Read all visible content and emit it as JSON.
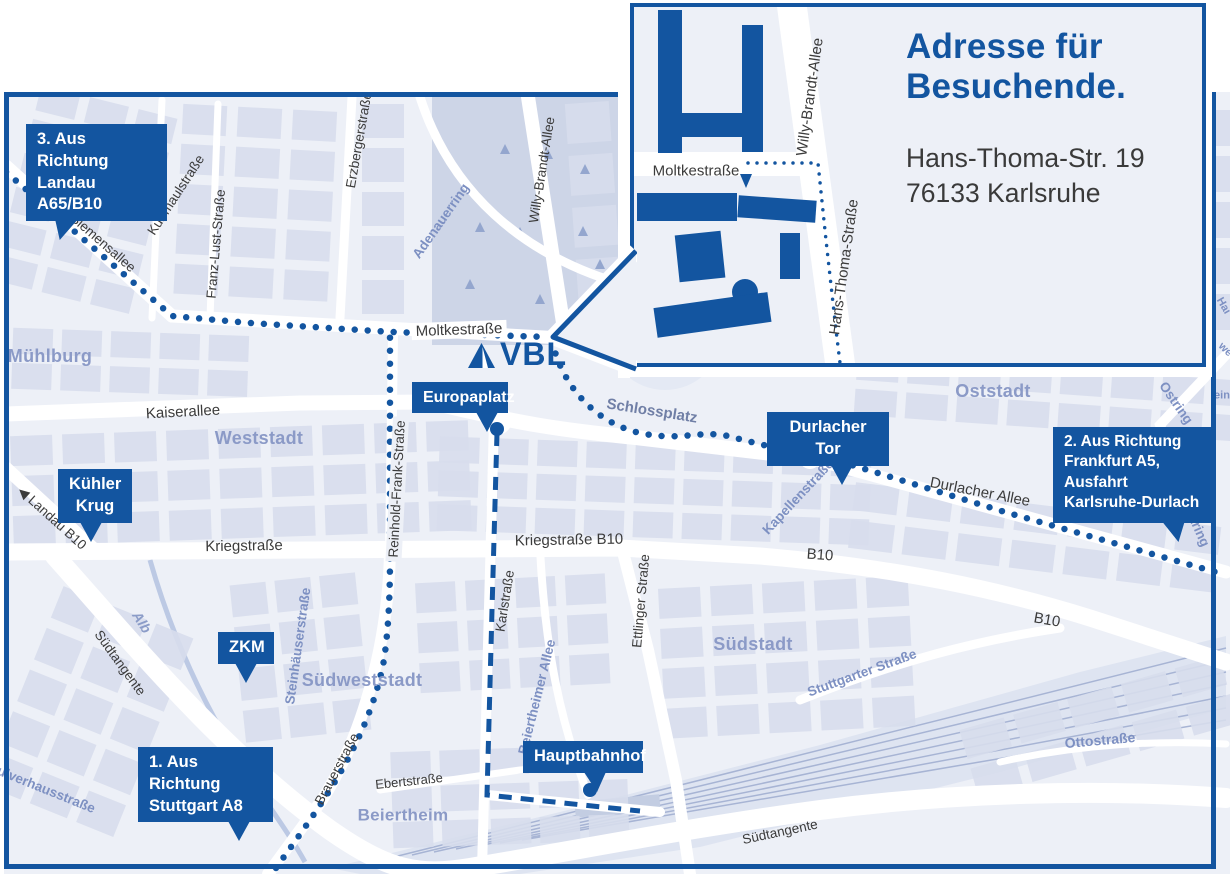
{
  "colors": {
    "brand": "#1355a0",
    "map_bg": "#edf0f7",
    "block": "#d7ddec",
    "park": "#cdd5e7",
    "district_text": "#8b9ac7",
    "street_text": "#3b3b3b",
    "street_text_blue": "#7d90c2",
    "route": "#1355a0"
  },
  "logo": {
    "text": "VBL"
  },
  "inset": {
    "title": "Adresse für\nBesuchende.",
    "address": "Hans-Thoma-Str. 19\n76133 Karlsruhe",
    "labels": [
      {
        "text": "Moltkestraße",
        "x": 62,
        "y": 164,
        "rot": 0
      },
      {
        "text": "Willy-Brandt-Allee",
        "x": 176,
        "y": 90,
        "rot": -82
      },
      {
        "text": "Hans-Thoma-Straße",
        "x": 210,
        "y": 260,
        "rot": -82
      }
    ]
  },
  "callouts": [
    {
      "id": "landau",
      "label": "3. Aus Richtung\nLandau A65/B10",
      "x": 26,
      "y": 124,
      "w": 141,
      "h": 48,
      "align": "left",
      "tail_x": 26,
      "tail_skew": -18,
      "fs": 16.5
    },
    {
      "id": "kuehler-krug",
      "label": "Kühler\nKrug",
      "x": 58,
      "y": 469,
      "w": 74,
      "h": 46,
      "align": "center",
      "tail_x": 22,
      "tail_skew": 0,
      "fs": 16.5
    },
    {
      "id": "zkm",
      "label": "ZKM",
      "x": 218,
      "y": 632,
      "w": 56,
      "h": 28,
      "align": "center",
      "tail_x": 17,
      "tail_skew": 0,
      "fs": 16.5
    },
    {
      "id": "stuttgart",
      "label": "1. Aus Richtung\nStuttgart A8",
      "x": 138,
      "y": 747,
      "w": 135,
      "h": 50,
      "align": "left",
      "tail_x": 90,
      "tail_skew": 0,
      "fs": 16.5
    },
    {
      "id": "europaplatz",
      "label": "Europaplatz",
      "x": 412,
      "y": 382,
      "w": 96,
      "h": 28,
      "align": "center",
      "tail_x": 64,
      "tail_skew": 0,
      "fs": 16
    },
    {
      "id": "durlacher-tor",
      "label": "Durlacher Tor",
      "x": 767,
      "y": 412,
      "w": 122,
      "h": 27,
      "align": "center",
      "tail_x": 64,
      "tail_skew": 0,
      "fs": 16.5
    },
    {
      "id": "frankfurt",
      "label": "2. Aus Richtung\nFrankfurt A5,\nAusfahrt\nKarlsruhe-Durlach",
      "x": 1053,
      "y": 427,
      "w": 160,
      "h": 96,
      "align": "left",
      "tail_x": 112,
      "tail_skew": 14,
      "fs": 15.5
    },
    {
      "id": "hauptbahnhof",
      "label": "Hauptbahnhof",
      "x": 523,
      "y": 741,
      "w": 120,
      "h": 30,
      "align": "center",
      "tail_x": 62,
      "tail_skew": 6,
      "fs": 16.5
    }
  ],
  "stations": [
    {
      "name": "Europaplatz",
      "x": 497,
      "y": 429
    },
    {
      "name": "Hauptbahnhof",
      "x": 590,
      "y": 790
    }
  ],
  "map_labels": [
    {
      "t": "Siemensallee",
      "x": 103,
      "y": 243,
      "r": 41,
      "c": "s"
    },
    {
      "t": "Kußmaulstraße",
      "x": 176,
      "y": 195,
      "r": -57,
      "c": "s"
    },
    {
      "t": "Franz-Lust-Straße",
      "x": 216,
      "y": 244,
      "r": -85,
      "c": "s"
    },
    {
      "t": "Erzbergerstraße",
      "x": 359,
      "y": 140,
      "r": -80,
      "c": "s"
    },
    {
      "t": "Adenauerring",
      "x": 441,
      "y": 221,
      "r": -55,
      "c": "b"
    },
    {
      "t": "Willy-Brandt-Allee",
      "x": 542,
      "y": 170,
      "r": -81,
      "c": "s"
    },
    {
      "t": "Moltkestraße",
      "x": 459,
      "y": 330,
      "r": -2,
      "c": "sl",
      "bg": "#ffffff"
    },
    {
      "t": "Kaiserallee",
      "x": 183,
      "y": 412,
      "r": -3,
      "c": "sl"
    },
    {
      "t": "Weststadt",
      "x": 259,
      "y": 438,
      "r": 0,
      "c": "d"
    },
    {
      "t": "Mühlburg",
      "x": 50,
      "y": 356,
      "r": 0,
      "c": "d"
    },
    {
      "t": "Kriegstraße",
      "x": 244,
      "y": 546,
      "r": -1,
      "c": "sl"
    },
    {
      "t": "Kriegstraße B10",
      "x": 569,
      "y": 540,
      "r": -1,
      "c": "sl"
    },
    {
      "t": "Reinhold-Frank-Straße",
      "x": 397,
      "y": 489,
      "r": -87,
      "c": "s",
      "bg": "#edf0f7"
    },
    {
      "t": "Karlstraße",
      "x": 505,
      "y": 601,
      "r": -81,
      "c": "s"
    },
    {
      "t": "Ettlinger Straße",
      "x": 641,
      "y": 601,
      "r": -85,
      "c": "s"
    },
    {
      "t": "Beiertheimer Allee",
      "x": 537,
      "y": 697,
      "r": -76,
      "c": "b"
    },
    {
      "t": "Steinhäuserstraße",
      "x": 298,
      "y": 646,
      "r": -82,
      "c": "b"
    },
    {
      "t": "Brauerstraße",
      "x": 337,
      "y": 769,
      "r": -62,
      "c": "s"
    },
    {
      "t": "Ebertstraße",
      "x": 409,
      "y": 781,
      "r": -6,
      "c": "s",
      "sz": 13
    },
    {
      "t": "Beiertheim",
      "x": 403,
      "y": 815,
      "r": 0,
      "c": "d",
      "sz": 17
    },
    {
      "t": "Südweststadt",
      "x": 362,
      "y": 680,
      "r": 0,
      "c": "d"
    },
    {
      "t": "Südstadt",
      "x": 753,
      "y": 644,
      "r": 0,
      "c": "d"
    },
    {
      "t": "Oststadt",
      "x": 993,
      "y": 391,
      "r": 0,
      "c": "d"
    },
    {
      "t": "Schlossplatz",
      "x": 652,
      "y": 411,
      "r": 9,
      "c": "p"
    },
    {
      "t": "Durlacher Allee",
      "x": 980,
      "y": 492,
      "r": 11,
      "c": "sl"
    },
    {
      "t": "Kapellenstraße",
      "x": 798,
      "y": 497,
      "r": -47,
      "c": "b"
    },
    {
      "t": "B10",
      "x": 820,
      "y": 555,
      "r": 4,
      "c": "sl"
    },
    {
      "t": "B10",
      "x": 1047,
      "y": 620,
      "r": 10,
      "c": "sl"
    },
    {
      "t": "Stuttgarter Straße",
      "x": 862,
      "y": 673,
      "r": -20,
      "c": "b"
    },
    {
      "t": "Südtangente",
      "x": 120,
      "y": 663,
      "r": 54,
      "c": "s"
    },
    {
      "t": "Südtangente",
      "x": 780,
      "y": 832,
      "r": -12,
      "c": "s"
    },
    {
      "t": "Ottostraße",
      "x": 1100,
      "y": 740,
      "r": -5,
      "c": "b",
      "sz": 14
    },
    {
      "t": "Ostring",
      "x": 1176,
      "y": 403,
      "r": 55,
      "c": "b"
    },
    {
      "t": "Ostring",
      "x": 1196,
      "y": 524,
      "r": 66,
      "c": "b"
    },
    {
      "t": "◀ Landau B10",
      "x": 52,
      "y": 518,
      "r": 42,
      "c": "s"
    },
    {
      "t": "Pulverhausstraße",
      "x": 42,
      "y": 788,
      "r": 22,
      "c": "b"
    },
    {
      "t": "Alb",
      "x": 142,
      "y": 622,
      "r": 58,
      "c": "w"
    },
    {
      "t": "Hai",
      "x": 1223,
      "y": 306,
      "r": 60,
      "c": "f"
    },
    {
      "t": "we",
      "x": 1225,
      "y": 350,
      "r": 45,
      "c": "f"
    },
    {
      "t": "ein",
      "x": 1222,
      "y": 396,
      "r": 0,
      "c": "f"
    }
  ]
}
